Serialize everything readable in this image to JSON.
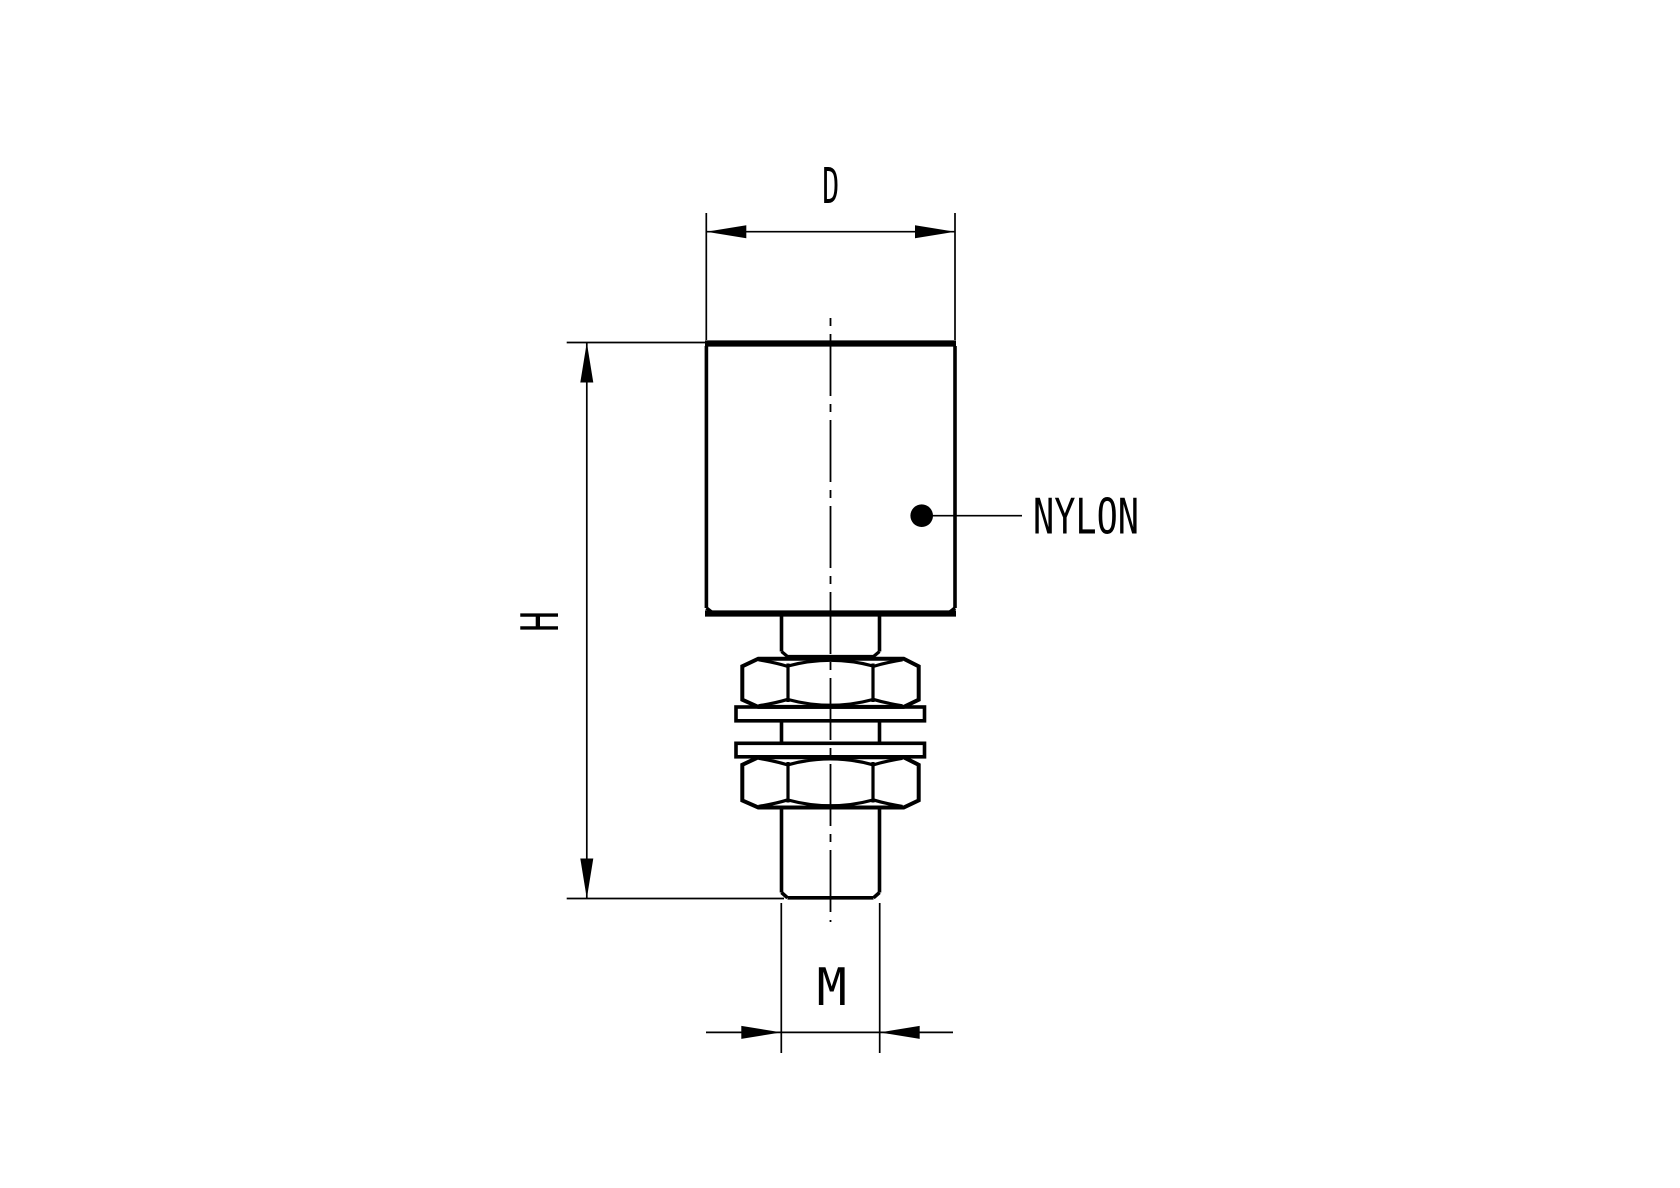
{
  "page": {
    "background_color": "#ffffff"
  },
  "drawing": {
    "kind": "technical-drawing",
    "line_color": "#000000",
    "dimension_labels": {
      "diameter": "D",
      "height": "H",
      "thread": "M"
    },
    "material_callout": {
      "label": "NYLON"
    }
  }
}
